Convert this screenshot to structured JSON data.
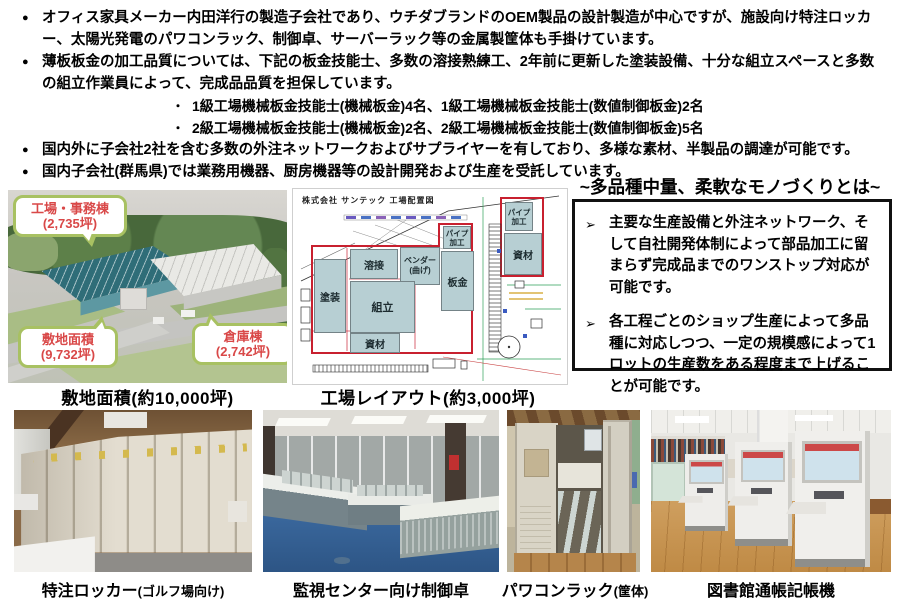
{
  "markers": {
    "bullet": "●",
    "sub_bullet": "・",
    "arrow": "➢"
  },
  "bullets": [
    {
      "text": "オフィス家具メーカー内田洋行の製造子会社であり、ウチダブランドのOEM製品の設計製造が中心ですが、施設向け特注ロッカー、太陽光発電のパワコンラック、制御卓、サーバーラック等の金属製筐体も手掛けています。"
    },
    {
      "text": "薄板板金の加工品質については、下記の板金技能士、多数の溶接熟練工、2年前に更新した塗装設備、十分な組立スペースと多数の組立作業員によって、完成品品質を担保しています。"
    },
    {
      "text": "1級工場機械板金技能士(機械板金)4名、1級工場機械板金技能士(数値制御板金)2名"
    },
    {
      "text": "2級工場機械板金技能士(機械板金)2名、2級工場機械板金技能士(数値制御板金)5名"
    },
    {
      "text": "国内外に子会社2社を含む多数の外注ネットワークおよびサプライヤーを有しており、多様な素材、半製品の調達が可能です。"
    },
    {
      "text": "国内子会社(群馬県)では業務用機器、厨房機器等の設計開発および生産を受託しています。"
    }
  ],
  "site": {
    "callouts": [
      {
        "name": "工場・事務棟",
        "value": "(2,735坪)"
      },
      {
        "name": "敷地面積",
        "value": "(9,732坪)"
      },
      {
        "name": "倉庫棟",
        "value": "(2,742坪)"
      }
    ],
    "caption": "敷地面積(約10,000坪)"
  },
  "diagram": {
    "title": "株式会社 サンテック 工場配置図",
    "rooms": [
      {
        "label": "塗装"
      },
      {
        "label": "溶接"
      },
      {
        "label": "ベンダー\n(曲げ)"
      },
      {
        "label": "パイプ\n加工"
      },
      {
        "label": "板金"
      },
      {
        "label": "組立"
      },
      {
        "label": "資材"
      },
      {
        "label": "パイプ\n加工"
      },
      {
        "label": "資材"
      }
    ],
    "caption": "工場レイアウト(約3,000坪)"
  },
  "highlight": {
    "title": "~多品種中量、柔軟なモノづくりとは~",
    "points": [
      {
        "text": "主要な生産設備と外注ネットワーク、そして自社開発体制によって部品加工に留まらず完成品までのワンストップ対応が可能です。"
      },
      {
        "text": "各工程ごとのショップ生産によって多品種に対応しつつ、一定の規模感によって1ロットの生産数をある程度まで上げることが可能です。"
      }
    ]
  },
  "photos": [
    {
      "main": "特注ロッカー",
      "sub": "(ゴルフ場向け)"
    },
    {
      "main": "監視センター向け制御卓",
      "sub": ""
    },
    {
      "main": "パワコンラック",
      "sub": "(筐体)"
    },
    {
      "main": "図書館通帳記帳機",
      "sub": ""
    }
  ]
}
